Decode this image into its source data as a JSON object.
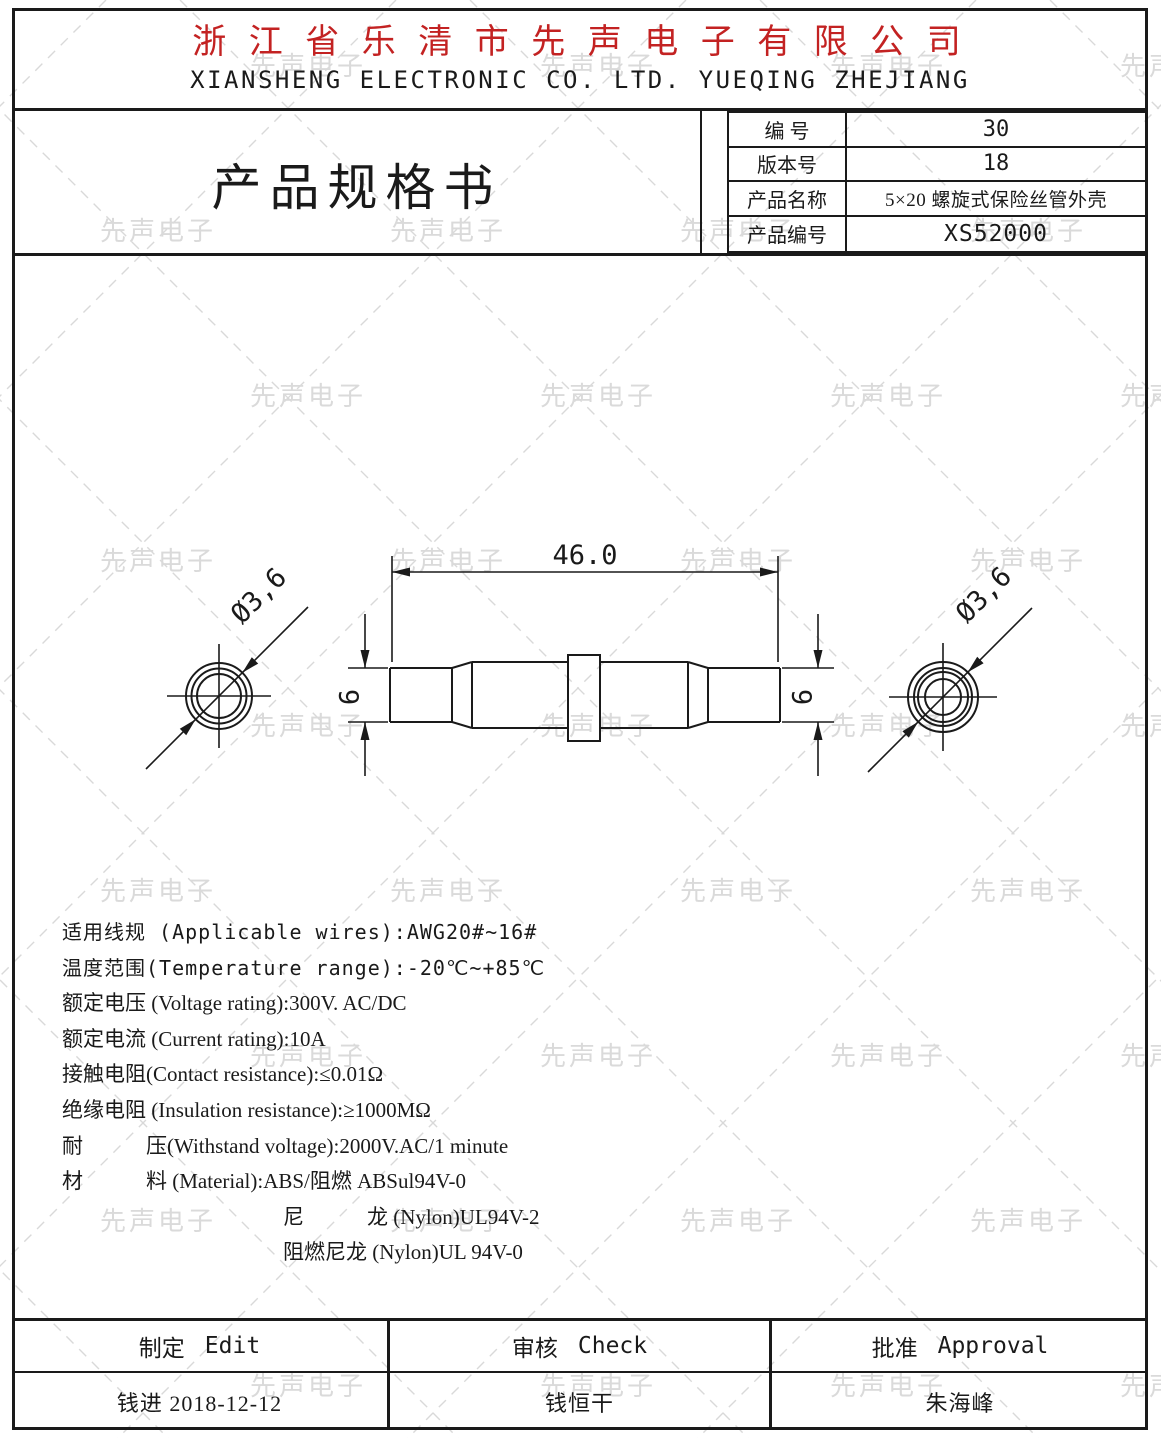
{
  "watermark": {
    "text": "先声电子"
  },
  "header": {
    "company_cn": "浙 江 省 乐 清 市 先 声 电 子 有 限 公 司",
    "company_en": "XIANSHENG ELECTRONIC CO. LTD. YUEQING ZHEJIANG",
    "accent_color": "#c32222"
  },
  "title_block": {
    "doc_title": "产品规格书",
    "rows": [
      {
        "label": "编 号",
        "value": "30"
      },
      {
        "label": "版本号",
        "value": "18"
      },
      {
        "label": "产品名称",
        "value": "5×20 螺旋式保险丝管外壳"
      },
      {
        "label": "产品编号",
        "value": "XS52000"
      }
    ]
  },
  "drawing": {
    "dim_length": "46.0",
    "dim_height_left": "6",
    "dim_height_right": "6",
    "dim_diameter_left": "Ø3,6",
    "dim_diameter_right": "Ø3,6"
  },
  "specs": {
    "lines": [
      "适用线规 (Applicable wires):AWG20#~16#",
      "温度范围(Temperature range):-20℃~+85℃",
      "额定电压 (Voltage rating):300V. AC/DC",
      "额定电流 (Current rating):10A",
      "接触电阻(Contact resistance):≤0.01Ω",
      "绝缘电阻 (Insulation resistance):≥1000MΩ",
      "耐　　　压(Withstand voltage):2000V.AC/1 minute",
      "材　　　料 (Material):ABS/阻燃 ABSul94V-0",
      "尼　　　龙 (Nylon)UL94V-2",
      "阻燃尼龙 (Nylon)UL 94V-0"
    ]
  },
  "approval": {
    "headers": [
      {
        "cn": "制定",
        "en": "Edit"
      },
      {
        "cn": "审核",
        "en": "Check"
      },
      {
        "cn": "批准",
        "en": "Approval"
      }
    ],
    "values": [
      "钱进 2018-12-12",
      "钱恒干",
      "朱海峰"
    ]
  }
}
